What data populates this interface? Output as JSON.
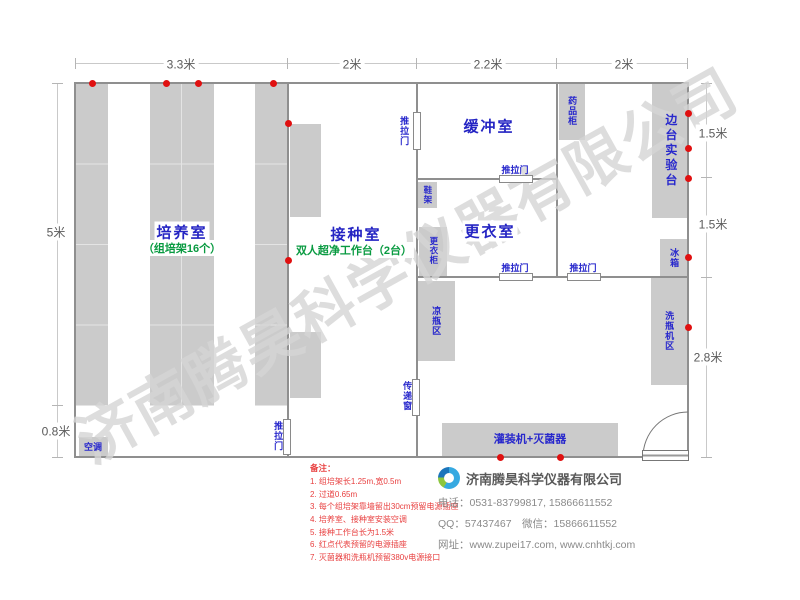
{
  "watermark": {
    "text": "济南腾昊科学仪器有限公司"
  },
  "dims": {
    "top": [
      "3.3米",
      "2米",
      "2.2米",
      "2米"
    ],
    "left": [
      "5米",
      "0.8米"
    ],
    "right": [
      "1.5米",
      "1.5米",
      "2.8米"
    ]
  },
  "rooms": {
    "peiyang": {
      "name": "培养室",
      "sub": "（组培架16个）"
    },
    "jiezhong": {
      "name": "接种室",
      "sub": "双人超净工作台（2台）"
    },
    "huanchong": {
      "name": "缓冲室"
    },
    "gengyi": {
      "name": "更衣室"
    }
  },
  "furniture": {
    "kongtiao": "空调",
    "tuilamen": "推拉门",
    "xiejia": "鞋架",
    "gengyigui": "更衣柜",
    "liangpingqu": "凉瓶区",
    "chuandichuang": "传递窗",
    "guanzhuang": "灌装机+灭菌器",
    "yaopingui": "药品柜",
    "biantai": "边台实验台",
    "bingxiang": "冰箱",
    "xipingji": "洗瓶机区"
  },
  "notes": {
    "title": "备注：",
    "items": [
      "1. 组培架长1.25m,宽0.5m",
      "2. 过道0.65m",
      "3. 每个组培架靠墙留出30cm预留电源插座",
      "4. 培养室、接种室安装空调",
      "5. 接种工作台长为1.5米",
      "6. 红点代表预留的电源插座",
      "7. 灭菌器和洗瓶机预留380v电源接口"
    ]
  },
  "company": {
    "name": "济南腾昊科学仪器有限公司",
    "phone": "电话：0531-83799817, 15866611552",
    "qq": "QQ：57437467　微信：15866611552",
    "web": "网址：www.zupei17.com, www.cnhtkj.com"
  },
  "colors": {
    "room_label_blue": "#2424c3",
    "sub_label_green": "#089a40",
    "furniture_gray": "#cbcbcb",
    "note_red": "#e84040",
    "outlet_red": "#e01010"
  }
}
